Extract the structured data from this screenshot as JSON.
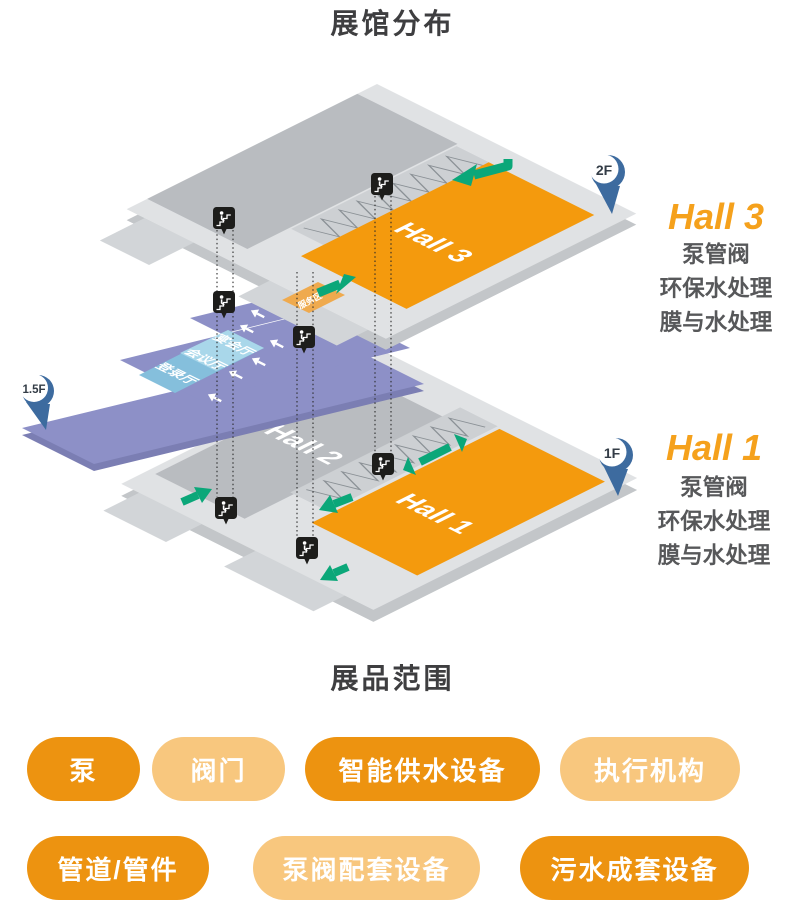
{
  "title": "展馆分布",
  "products_title": "展品范围",
  "diagram": {
    "pins": {
      "f2": "2F",
      "f15": "1.5F",
      "f1": "1F"
    },
    "floor_labels": {
      "hall3": "Hall 3",
      "hall2": "Hall 2",
      "hall1": "Hall 1"
    },
    "mezzanine_rooms": [
      "宴会厅",
      "会议厅",
      "登录厅"
    ],
    "corridor_label": "服务区"
  },
  "legend": {
    "hall3": {
      "name": "Hall 3",
      "lines": [
        "泵管阀",
        "环保水处理",
        "膜与水处理"
      ]
    },
    "hall1": {
      "name": "Hall 1",
      "lines": [
        "泵管阀",
        "环保水处理",
        "膜与水处理"
      ]
    }
  },
  "pills": [
    {
      "label": "泵",
      "variant": "dark"
    },
    {
      "label": "阀门",
      "variant": "light"
    },
    {
      "label": "智能供水设备",
      "variant": "dark"
    },
    {
      "label": "执行机构",
      "variant": "light"
    },
    {
      "label": "管道/管件",
      "variant": "dark"
    },
    {
      "label": "泵阀配套设备",
      "variant": "light"
    },
    {
      "label": "污水成套设备",
      "variant": "dark"
    }
  ],
  "colors": {
    "hall_orange": "#F49A0D",
    "pill_dark": "#ED9310",
    "pill_light": "#F8C77E",
    "arrow_green": "#0BA779",
    "mezzanine_purple": "#8D90C7",
    "pin_blue": "#3D6B9F",
    "label_orange": "#F5A11C",
    "text_gray": "#57585A"
  }
}
